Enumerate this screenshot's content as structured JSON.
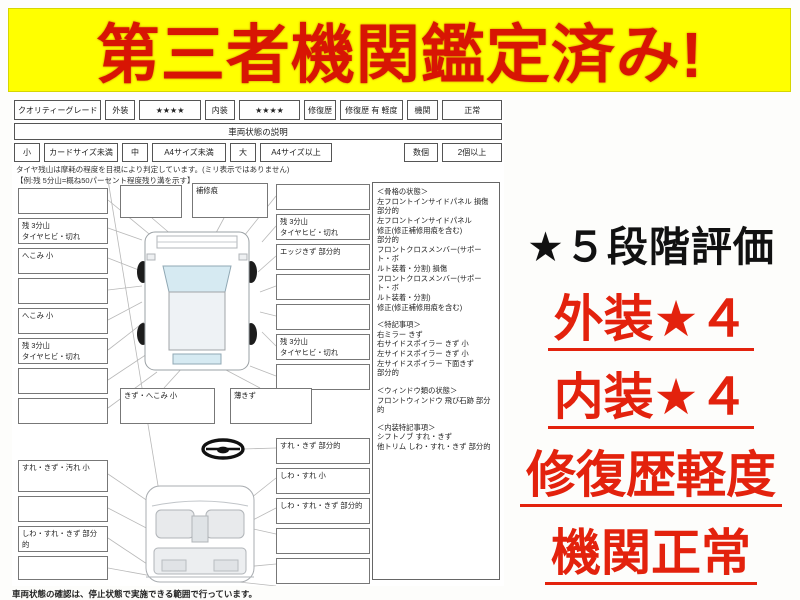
{
  "banner": {
    "text": "第三者機関鑑定済み!"
  },
  "grade_bar": {
    "cells": [
      "クオリティーグレード",
      "外装",
      "★★★★",
      "内装",
      "★★★★",
      "修復歴",
      "修復歴 有 軽度",
      "機関",
      "正常"
    ]
  },
  "section_title": "車両状態の説明",
  "size_legend": {
    "small": "小",
    "small_desc": "カードサイズ未満",
    "mid": "中",
    "mid_desc": "A4サイズ未満",
    "large": "大",
    "large_desc": "A4サイズ以上",
    "count": "数個",
    "count_desc": "2個以上"
  },
  "tire_note_line1": "タイヤ残山は摩耗の程度を目視により判定しています。(ミリ表示ではありません)",
  "tire_note_line2": "【例:残 5分山=概ね50パーセント程度残り溝を示す】",
  "diagram": {
    "left_top_boxes": [
      "",
      "残 3分山\nタイヤヒビ・切れ",
      "へこみ 小",
      "",
      "へこみ 小",
      "残 3分山\nタイヤヒビ・切れ",
      "",
      ""
    ],
    "right_top_boxes": [
      "",
      "残 3分山\nタイヤヒビ・切れ",
      "エッジきず 部分的",
      "",
      "",
      "残 3分山\nタイヤヒビ・切れ",
      ""
    ],
    "mid_boxes": [
      "",
      "補修痕"
    ],
    "under_boxes": [
      "きず・へこみ 小",
      "薄きず"
    ],
    "left_bottom_boxes": [
      "すれ・きず・汚れ 小",
      "",
      "しわ・すれ・きず 部分的",
      ""
    ],
    "right_bottom_boxes": [
      "すれ・きず 部分的",
      "しわ・すれ 小",
      "しわ・すれ・きず 部分的",
      "",
      ""
    ]
  },
  "conditions": {
    "sections": [
      {
        "title": "＜骨格の状態＞",
        "body": "左フロントインサイドパネル 損傷\n部分的\n左フロントインサイドパネル\n修正(修正補修用痕を含む)\n部分的\nフロントクロスメンバー(サポート・ボ\nルト装着・分割) 損傷\nフロントクロスメンバー(サポート・ボ\nルト装着・分割)\n修正(修正補修用痕を含む)"
      },
      {
        "title": "＜特記事項＞",
        "body": "右ミラー きず\n右サイドスポイラー きず 小\n左サイドスポイラー きず 小\n左サイドスポイラー 下面きず\n部分的"
      },
      {
        "title": "＜ウィンドウ類の状態＞",
        "body": "フロントウィンドウ 飛び石跡 部分的"
      },
      {
        "title": "＜内装特記事項＞",
        "body": "シフトノブ すれ・きず\n他トリム しわ・すれ・きず 部分的"
      }
    ]
  },
  "footer_note": "車両状態の確認は、停止状態で実施できる範囲で行っています。",
  "rating_panel": {
    "title": "★５段階評価",
    "items": [
      "外装★４",
      "内装★４",
      "修復歴軽度",
      "機関正常"
    ]
  },
  "colors": {
    "banner_bg": "#ffff00",
    "banner_text": "#d81504",
    "accent_red": "#e3220d",
    "rating_title": "#111111"
  }
}
